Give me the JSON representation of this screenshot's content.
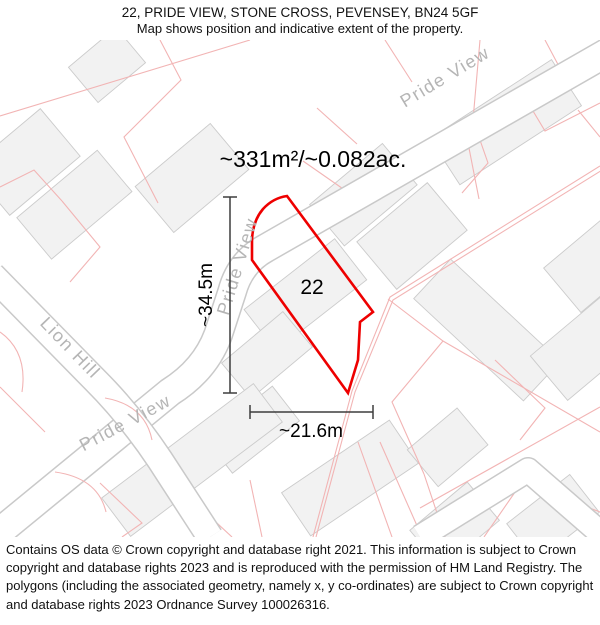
{
  "header": {
    "title": "22, PRIDE VIEW, STONE CROSS, PEVENSEY, BN24 5GF",
    "subtitle": "Map shows position and indicative extent of the property."
  },
  "map": {
    "area_label": "~331m²/~0.082ac.",
    "plot_number": "22",
    "width_label": "~21.6m",
    "height_label": "~34.5m",
    "street_labels": {
      "pride_view_top": "Pride View",
      "pride_view_mid": "Pride View",
      "pride_view_bottom": "Pride View",
      "lion_hill": "Lion Hill"
    },
    "colors": {
      "plot_outline": "#ee0000",
      "parcel_line": "#f2b4b4",
      "road_edge": "#c9c9c9",
      "building_fill": "#f2f2f2",
      "street_label": "#b5b5b5"
    }
  },
  "footer": {
    "attribution": "Contains OS data © Crown copyright and database right 2021. This information is subject to Crown copyright and database rights 2023 and is reproduced with the permission of HM Land Registry. The polygons (including the associated geometry, namely x, y co-ordinates) are subject to Crown copyright and database rights 2023 Ordnance Survey 100026316."
  }
}
